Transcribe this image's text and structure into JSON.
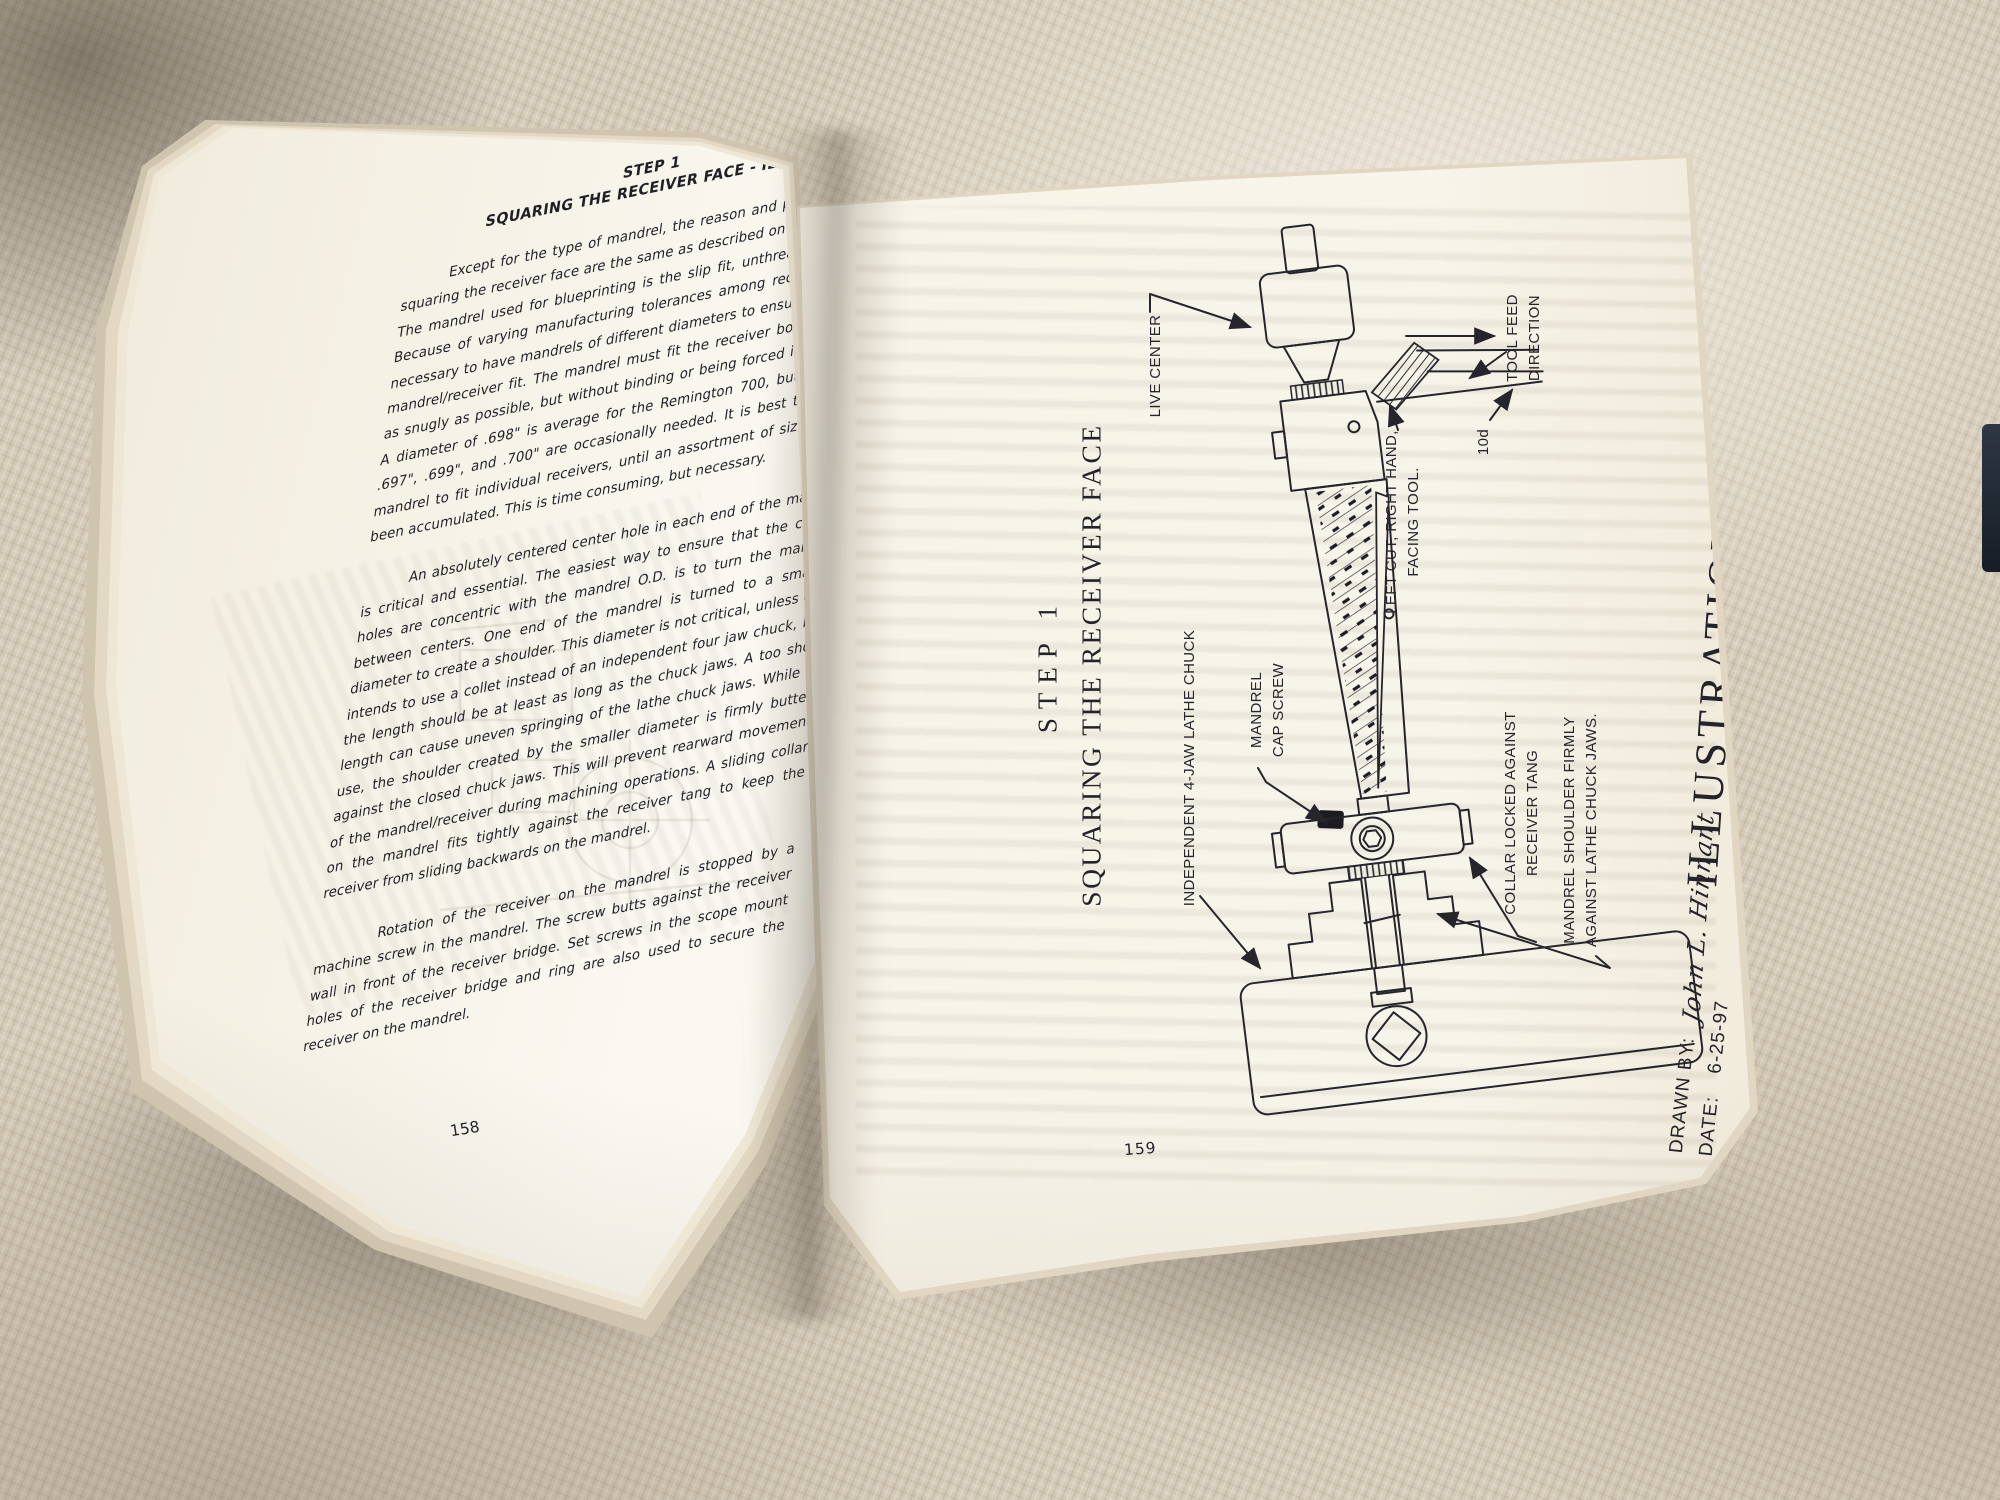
{
  "left_page": {
    "heading": [
      "STEP 1",
      "SQUARING THE RECEIVER FACE - ILL 73"
    ],
    "paragraphs": [
      "Except for the type of mandrel, the reason and procedures for squaring the receiver face are the same as described on pages 40-42. The mandrel used for blueprinting is the slip fit, unthreaded design. Because of varying manufacturing tolerances among receivers, it is necessary to have mandrels of different diameters to ensure a proper mandrel/receiver fit. The mandrel must fit the receiver bolt raceway as snugly as possible, but without binding or being forced into place. A diameter of .698\" is average for the Remington 700, but sizes of .697\", .699\", and .700\" are occasionally needed. It is best to turn a mandrel to fit individual receivers, until an assortment of sizes have been accumulated. This is time consuming, but necessary.",
      "An absolutely centered center hole in each end of the mandrel is critical and essential. The easiest way to ensure that the center holes are concentric with the mandrel O.D. is to turn the mandrel between centers. One end of the mandrel is turned to a smaller diameter to create a shoulder. This diameter is not critical, unless one intends to use a collet instead of an independent four jaw chuck, but the length should be at least as long as the chuck jaws. A too short length can cause uneven springing of the lathe chuck jaws. While in use, the shoulder created by the smaller diameter is firmly butted against the closed chuck jaws. This will prevent rearward movement of the mandrel/receiver during machining operations. A sliding collar on the mandrel fits tightly against the receiver tang to keep the receiver from sliding backwards on the mandrel.",
      "Rotation of the receiver on the mandrel is stopped by a machine screw in the mandrel. The screw butts against the receiver wall in front of the receiver bridge. Set screws in the scope mount holes of the receiver bridge and ring are also used to secure the receiver on the mandrel."
    ],
    "page_number": "158"
  },
  "right_page": {
    "heading": [
      "STEP 1",
      "SQUARING THE RECEIVER FACE"
    ],
    "callouts": {
      "live_center": "LIVE CENTER",
      "tool_feed": [
        "TOOL FEED",
        "DIRECTION"
      ],
      "facing_tool": [
        "LEFT CUT, RIGHT HAND,",
        "FACING TOOL."
      ],
      "tool_angle": "10d",
      "lathe_chuck": "INDEPENDENT 4-JAW LATHE CHUCK",
      "cap_screw": [
        "MANDREL",
        "CAP SCREW"
      ],
      "collar": [
        "COLLAR LOCKED AGAINST",
        "RECEIVER TANG"
      ],
      "shoulder": [
        "MANDREL SHOULDER FIRMLY",
        "AGAINST LATHE CHUCK JAWS."
      ]
    },
    "illustration_label": "ILLUSTRATION 73",
    "credits": {
      "drawn_by_label": "DRAWN BY:",
      "drawn_by_value": "John L. Hinnant",
      "date_label": "DATE:",
      "date_value": "6-25-97"
    },
    "page_number": "159"
  },
  "colors": {
    "paper": "#f7f3e8",
    "ink": "#26252b",
    "fabric": "#d5cab7"
  }
}
